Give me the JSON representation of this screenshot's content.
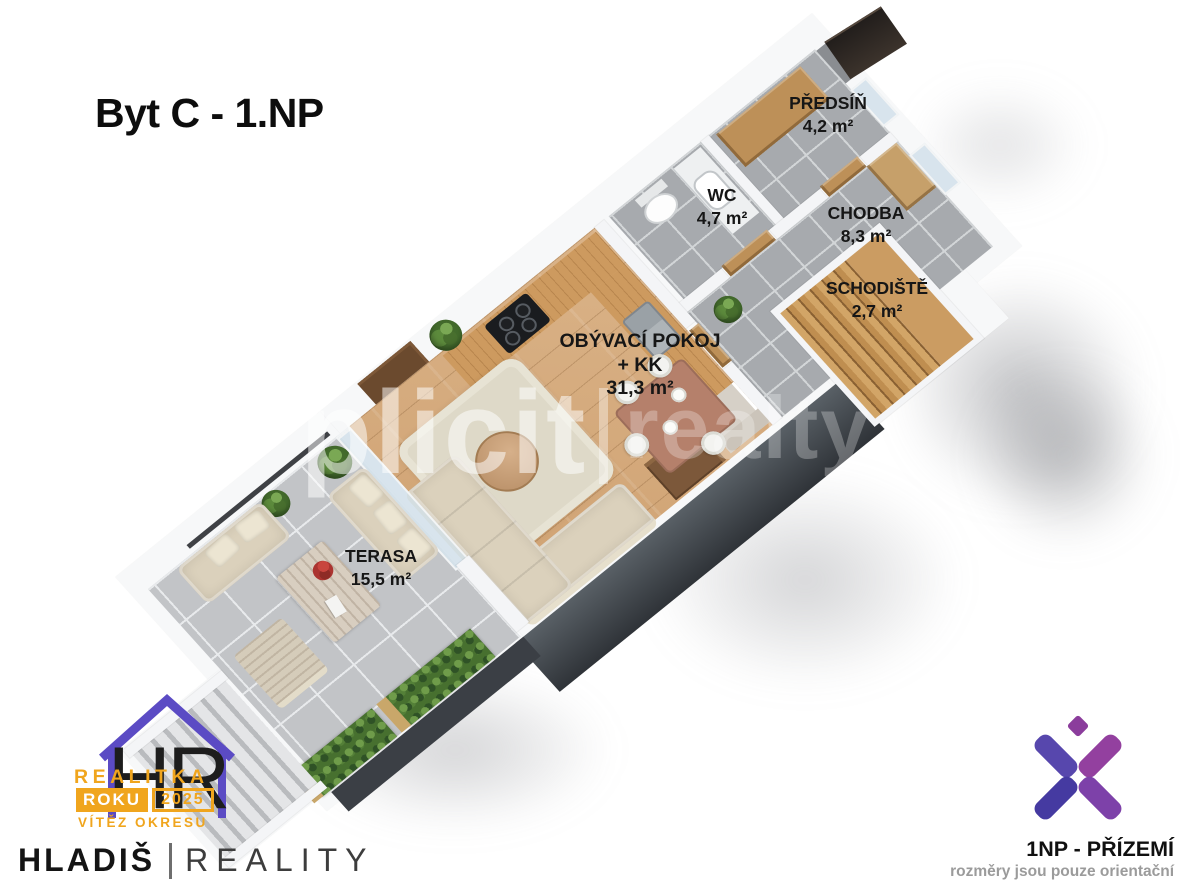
{
  "title": "Byt C - 1.NP",
  "rooms": [
    {
      "name": "PŘEDSÍŇ",
      "area": "4,2 m²"
    },
    {
      "name": "WC",
      "area": "4,7 m²"
    },
    {
      "name": "CHODBA",
      "area": "8,3 m²"
    },
    {
      "name": "SCHODIŠTĚ",
      "area": "2,7 m²"
    },
    {
      "name": "OBÝVACÍ POKOJ",
      "name_line2": "+ KK",
      "area": "31,3 m²"
    },
    {
      "name": "TERASA",
      "area": "15,5 m²"
    }
  ],
  "watermark": {
    "left": "plicit",
    "right": "realty"
  },
  "agency": {
    "monogram": "HR",
    "award_line1": "REALITKA",
    "award_word": "ROKU",
    "award_year": "2025",
    "award_line3": "VÍTĚZ OKRESU",
    "name_primary": "HLADIŠ",
    "name_secondary": "REALITY"
  },
  "floor_badge": {
    "label": "1NP - PŘÍZEMÍ",
    "disclaimer": "rozměry jsou pouze orientační"
  },
  "colors": {
    "award_yellow": "#f0a51d",
    "house_purple": "#5b4bc4",
    "xlogo_indigo": "#453aa1",
    "xlogo_magenta": "#9b3a93",
    "label_black": "#161616",
    "disclaimer_gray": "#9b9b9b",
    "facade_dark": "#31353b",
    "wood_floor": "#d4ab7e",
    "tile_gray": "#a7aaae"
  }
}
